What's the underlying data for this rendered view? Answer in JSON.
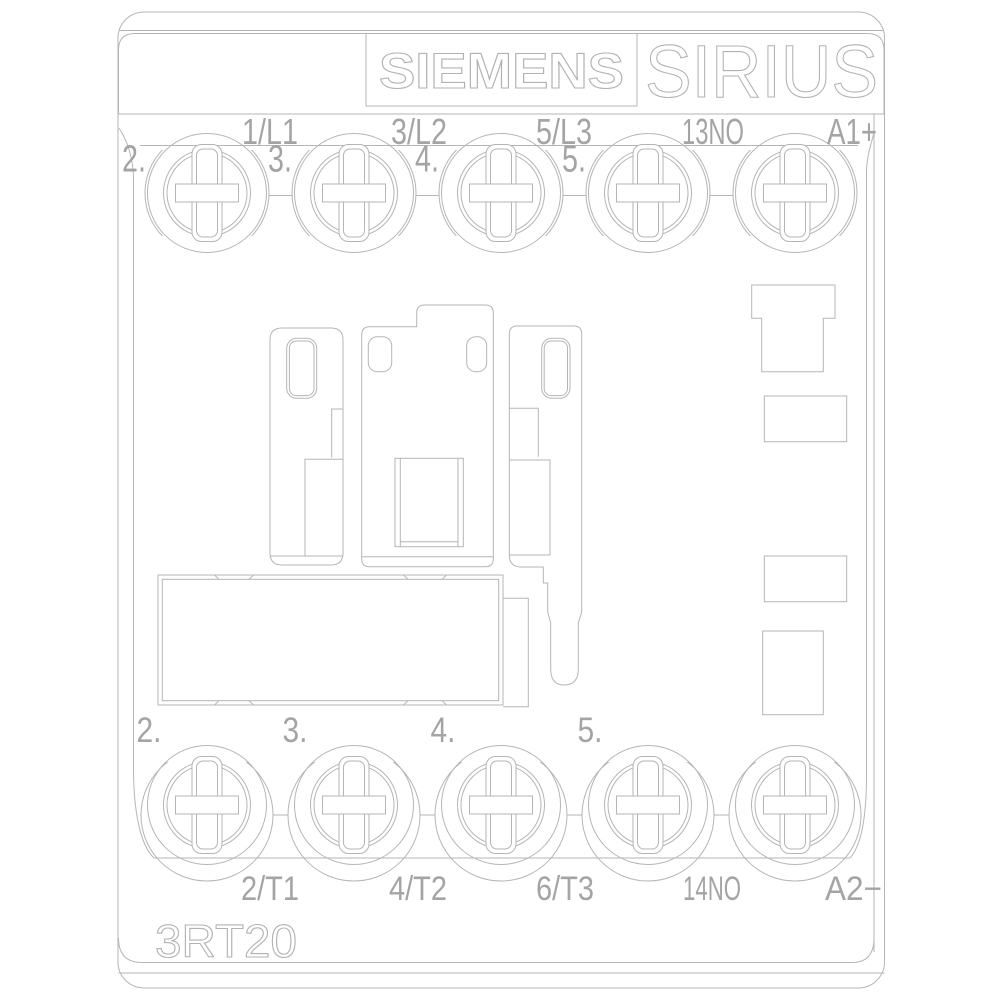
{
  "device": {
    "brand": "SIEMENS",
    "series": "SIRIUS",
    "model": "3RT20"
  },
  "terminals": {
    "top": {
      "labels": [
        "1/L1",
        "3/L2",
        "5/L3",
        "13NO",
        "A1+"
      ],
      "clamp_numbers": [
        "2.",
        "3.",
        "4.",
        "5."
      ]
    },
    "bottom": {
      "labels": [
        "2/T1",
        "4/T2",
        "6/T3",
        "14NO",
        "A2−"
      ],
      "clamp_numbers": [
        "2.",
        "3.",
        "4.",
        "5."
      ]
    }
  },
  "style": {
    "line_color": "#b5b5b5",
    "text_color": "#a4a4a4",
    "background": "#ffffff"
  }
}
